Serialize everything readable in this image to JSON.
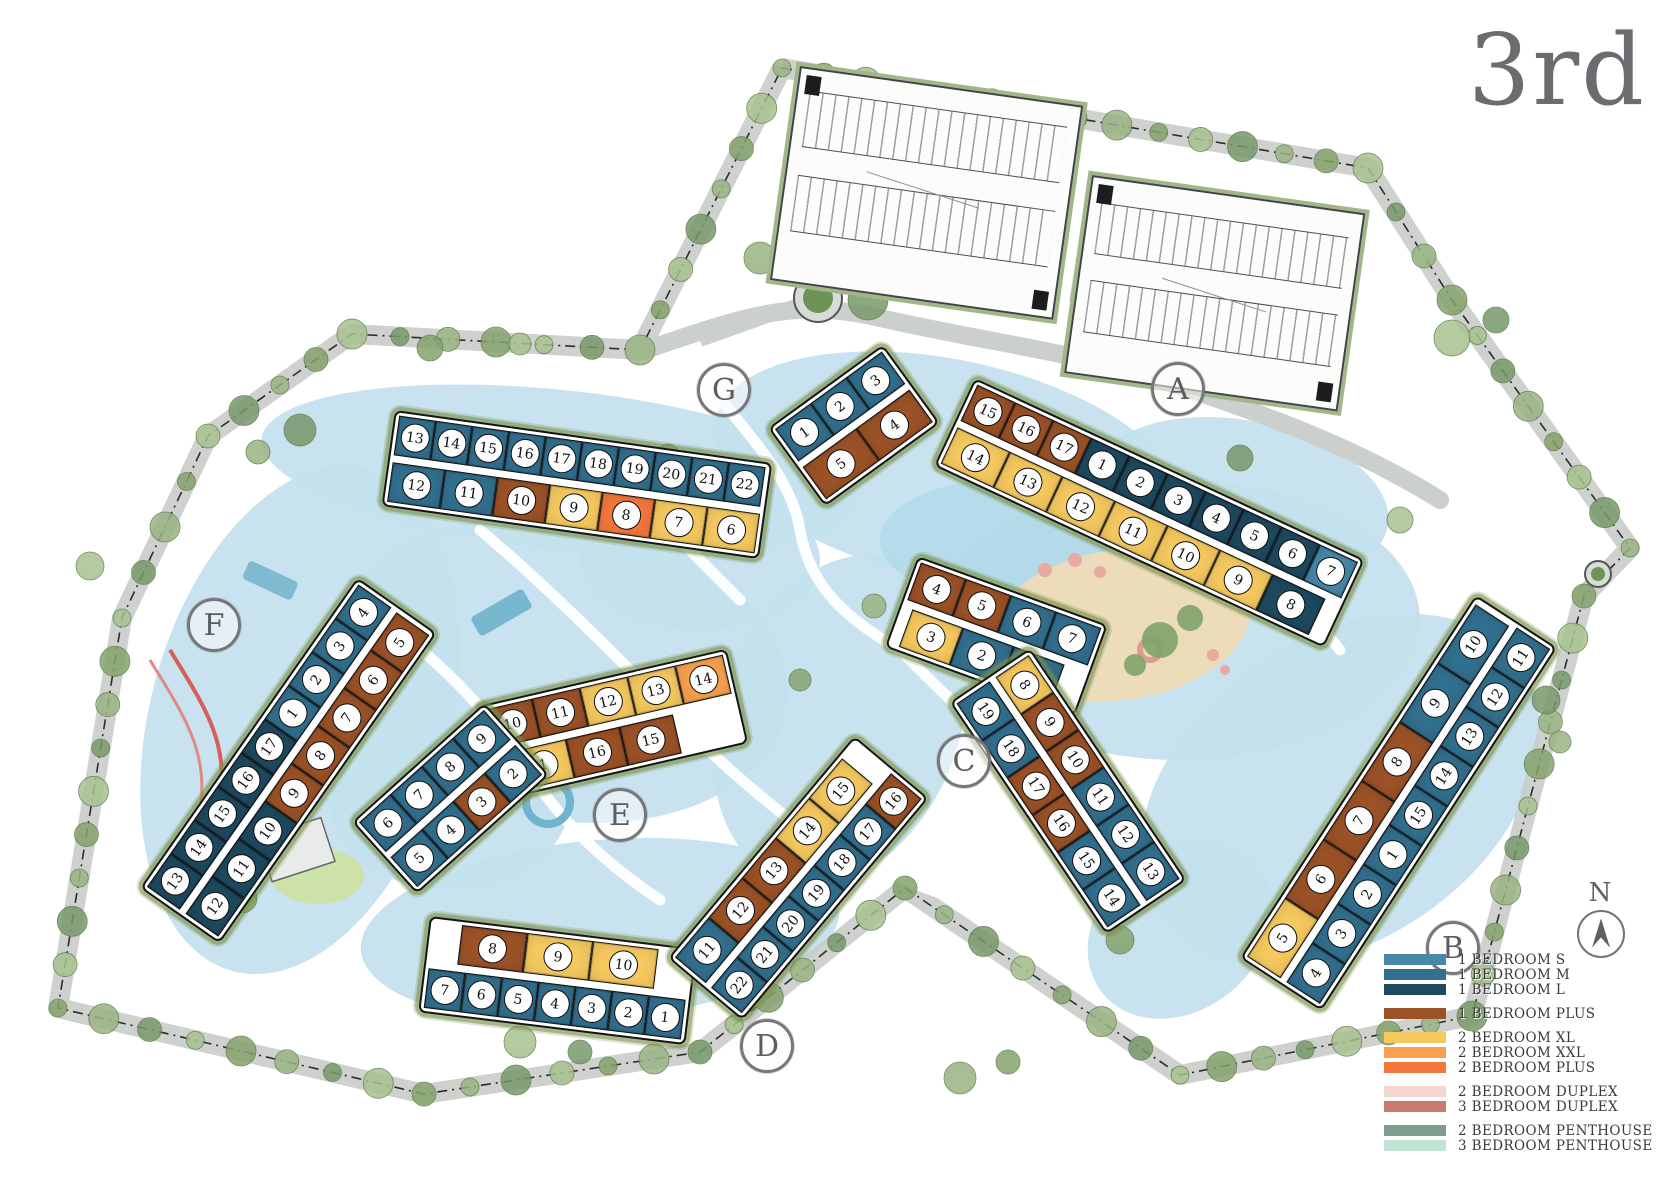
{
  "title": "3rd",
  "compass": {
    "label": "N"
  },
  "legend": {
    "groups": [
      {
        "items": [
          {
            "key": "b1s",
            "label": "1 BEDROOM S",
            "color": "#4788aa"
          },
          {
            "key": "b1m",
            "label": "1 BEDROOM M",
            "color": "#32708f"
          },
          {
            "key": "b1l",
            "label": "1 BEDROOM L",
            "color": "#1d4a61"
          }
        ]
      },
      {
        "items": [
          {
            "key": "b1plus",
            "label": "1 BEDROOM PLUS",
            "color": "#9c5227"
          }
        ]
      },
      {
        "items": [
          {
            "key": "b2xl",
            "label": "2 BEDROOM XL",
            "color": "#f6c95f"
          },
          {
            "key": "b2xxl",
            "label": "2 BEDROOM XXL",
            "color": "#f8a14e"
          },
          {
            "key": "b2plus",
            "label": "2 BEDROOM PLUS",
            "color": "#f4773d"
          }
        ]
      },
      {
        "items": [
          {
            "key": "b2duplex",
            "label": "2 BEDROOM DUPLEX",
            "color": "#f2d8cf"
          },
          {
            "key": "b3duplex",
            "label": "3 BEDROOM DUPLEX",
            "color": "#ca7b6d"
          }
        ]
      },
      {
        "items": [
          {
            "key": "b2ph",
            "label": "2 BEDROOM PENTHOUSE",
            "color": "#7d9d8d"
          },
          {
            "key": "b3ph",
            "label": "3 BEDROOM PENTHOUSE",
            "color": "#c2e4d4"
          }
        ]
      }
    ]
  },
  "buildings": [
    {
      "id": "G",
      "badge": {
        "x": 723,
        "y": 389
      },
      "segments": [
        {
          "x": 395,
          "y": 410,
          "angle": 8,
          "rows": [
            {
              "w": 37,
              "units": [
                {
                  "n": "13",
                  "t": "b1m"
                },
                {
                  "n": "14",
                  "t": "b1m"
                },
                {
                  "n": "15",
                  "t": "b1m"
                },
                {
                  "n": "16",
                  "t": "b1m"
                },
                {
                  "n": "17",
                  "t": "b1m"
                },
                {
                  "n": "18",
                  "t": "b1m"
                },
                {
                  "n": "19",
                  "t": "b1m"
                },
                {
                  "n": "20",
                  "t": "b1m"
                },
                {
                  "n": "21",
                  "t": "b1m"
                },
                {
                  "n": "22",
                  "t": "b1m"
                }
              ]
            },
            {
              "w": 53,
              "units": [
                {
                  "n": "12",
                  "t": "b1m"
                },
                {
                  "n": "11",
                  "t": "b1m"
                },
                {
                  "n": "10",
                  "t": "b1plus"
                },
                {
                  "n": "9",
                  "t": "b2xl"
                },
                {
                  "n": "8",
                  "t": "b2plus"
                },
                {
                  "n": "7",
                  "t": "b2xl"
                },
                {
                  "n": "6",
                  "t": "b2xl"
                }
              ]
            }
          ]
        },
        {
          "x": 768,
          "y": 428,
          "angle": -36,
          "rows": [
            {
              "w": 44,
              "units": [
                {
                  "n": "1",
                  "t": "b1m"
                },
                {
                  "n": "2",
                  "t": "b1m"
                },
                {
                  "n": "3",
                  "t": "b1m"
                }
              ]
            },
            {
              "w": 66,
              "units": [
                {
                  "n": "5",
                  "t": "b1plus"
                },
                {
                  "n": "4",
                  "t": "b1plus"
                }
              ]
            }
          ]
        }
      ]
    },
    {
      "id": "A",
      "badge": {
        "x": 1177,
        "y": 388
      },
      "segments": [
        {
          "x": 975,
          "y": 378,
          "angle": 25,
          "rows": [
            {
              "w": 42,
              "units": [
                {
                  "n": "15",
                  "t": "b1plus"
                },
                {
                  "n": "16",
                  "t": "b1plus"
                },
                {
                  "n": "17",
                  "t": "b1plus"
                },
                {
                  "n": "1",
                  "t": "b1l"
                },
                {
                  "n": "2",
                  "t": "b1l"
                },
                {
                  "n": "3",
                  "t": "b1l"
                },
                {
                  "n": "4",
                  "t": "b1l"
                },
                {
                  "n": "5",
                  "t": "b1l"
                },
                {
                  "n": "6",
                  "t": "b1l"
                },
                {
                  "n": "7",
                  "t": "b1s"
                }
              ]
            },
            {
              "w": 58,
              "units": [
                {
                  "n": "14",
                  "t": "b2xl"
                },
                {
                  "n": "13",
                  "t": "b2xl"
                },
                {
                  "n": "12",
                  "t": "b2xl"
                },
                {
                  "n": "11",
                  "t": "b2xl"
                },
                {
                  "n": "10",
                  "t": "b2xl"
                },
                {
                  "n": "9",
                  "t": "b2xl"
                },
                {
                  "n": "8",
                  "t": "b1l"
                }
              ]
            }
          ]
        }
      ]
    },
    {
      "id": "B",
      "badge": {
        "x": 1452,
        "y": 947
      },
      "segments": [
        {
          "x": 1240,
          "y": 958,
          "angle": -57,
          "rows": [
            {
              "w": 70,
              "units": [
                {
                  "n": "5",
                  "t": "b2xl"
                },
                {
                  "n": "6",
                  "t": "b1plus"
                },
                {
                  "n": "7",
                  "t": "b1plus"
                },
                {
                  "n": "8",
                  "t": "b1plus"
                },
                {
                  "n": "9",
                  "t": "b1m"
                },
                {
                  "n": "10",
                  "t": "b1m"
                }
              ]
            },
            {
              "w": 47,
              "units": [
                {
                  "n": "4",
                  "t": "b1m"
                },
                {
                  "n": "3",
                  "t": "b1m"
                },
                {
                  "n": "2",
                  "t": "b1m"
                },
                {
                  "n": "1",
                  "t": "b1m"
                },
                {
                  "n": "15",
                  "t": "b1m"
                },
                {
                  "n": "14",
                  "t": "b1m"
                },
                {
                  "n": "13",
                  "t": "b1m"
                },
                {
                  "n": "12",
                  "t": "b1m"
                },
                {
                  "n": "11",
                  "t": "b1m"
                }
              ]
            }
          ]
        }
      ]
    },
    {
      "id": "C",
      "badge": {
        "x": 963,
        "y": 760
      },
      "segments": [
        {
          "x": 918,
          "y": 556,
          "angle": 20,
          "rows": [
            {
              "w": 48,
              "units": [
                {
                  "n": "4",
                  "t": "b1plus"
                },
                {
                  "n": "5",
                  "t": "b1plus"
                },
                {
                  "n": "6",
                  "t": "b1m"
                },
                {
                  "n": "7",
                  "t": "b1m"
                }
              ]
            },
            {
              "w": 54,
              "ml": 8,
              "units": [
                {
                  "n": "3",
                  "t": "b2xl"
                },
                {
                  "n": "2",
                  "t": "b1m"
                },
                {
                  "n": "1",
                  "t": "b1m"
                }
              ]
            }
          ]
        },
        {
          "x": 1030,
          "y": 648,
          "angle": 56,
          "rows": [
            {
              "w": 45,
              "units": [
                {
                  "n": "8",
                  "t": "b2xl"
                },
                {
                  "n": "9",
                  "t": "b1plus"
                },
                {
                  "n": "10",
                  "t": "b1plus"
                },
                {
                  "n": "11",
                  "t": "b1m"
                },
                {
                  "n": "12",
                  "t": "b1m"
                },
                {
                  "n": "13",
                  "t": "b1m"
                }
              ]
            },
            {
              "w": 45,
              "units": [
                {
                  "n": "19",
                  "t": "b1m"
                },
                {
                  "n": "18",
                  "t": "b1m"
                },
                {
                  "n": "17",
                  "t": "b1plus"
                },
                {
                  "n": "16",
                  "t": "b1plus"
                },
                {
                  "n": "15",
                  "t": "b1m"
                },
                {
                  "n": "14",
                  "t": "b1m"
                }
              ]
            }
          ]
        }
      ]
    },
    {
      "id": "D",
      "badge": {
        "x": 766,
        "y": 1045
      },
      "segments": [
        {
          "x": 430,
          "y": 916,
          "angle": 7,
          "rows": [
            {
              "w": 66,
              "ml": 28,
              "units": [
                {
                  "n": "8",
                  "t": "b1plus"
                },
                {
                  "n": "9",
                  "t": "b2xl"
                },
                {
                  "n": "10",
                  "t": "b2xl"
                }
              ]
            },
            {
              "w": 37,
              "units": [
                {
                  "n": "7",
                  "t": "b1m"
                },
                {
                  "n": "6",
                  "t": "b1m"
                },
                {
                  "n": "5",
                  "t": "b1m"
                },
                {
                  "n": "4",
                  "t": "b1m"
                },
                {
                  "n": "3",
                  "t": "b1m"
                },
                {
                  "n": "2",
                  "t": "b1m"
                },
                {
                  "n": "1",
                  "t": "b1m"
                }
              ]
            }
          ]
        },
        {
          "x": 668,
          "y": 958,
          "angle": -50,
          "rows": [
            {
              "w": 52,
              "units": [
                {
                  "n": "11",
                  "t": "b1m"
                },
                {
                  "n": "12",
                  "t": "b1plus"
                },
                {
                  "n": "13",
                  "t": "b1plus"
                },
                {
                  "n": "14",
                  "t": "b2xl"
                },
                {
                  "n": "15",
                  "t": "b2xl"
                }
              ]
            },
            {
              "w": 40,
              "units": [
                {
                  "n": "22",
                  "t": "b1m"
                },
                {
                  "n": "21",
                  "t": "b1m"
                },
                {
                  "n": "20",
                  "t": "b1m"
                },
                {
                  "n": "19",
                  "t": "b1m"
                },
                {
                  "n": "18",
                  "t": "b1m"
                },
                {
                  "n": "17",
                  "t": "b1m"
                },
                {
                  "n": "16",
                  "t": "b1plus"
                }
              ]
            }
          ]
        }
      ]
    },
    {
      "id": "E",
      "badge": {
        "x": 619,
        "y": 814
      },
      "segments": [
        {
          "x": 478,
          "y": 706,
          "angle": -13,
          "rows": [
            {
              "w": 49,
              "units": [
                {
                  "n": "10",
                  "t": "b1plus"
                },
                {
                  "n": "11",
                  "t": "b1plus"
                },
                {
                  "n": "12",
                  "t": "b2xl"
                },
                {
                  "n": "13",
                  "t": "b2xl"
                },
                {
                  "n": "14",
                  "t": "b2xxl"
                }
              ]
            },
            {
              "w": 55,
              "ml": 18,
              "units": [
                {
                  "n": "1",
                  "t": "b2xl"
                },
                {
                  "n": "16",
                  "t": "b1plus"
                },
                {
                  "n": "15",
                  "t": "b1plus"
                }
              ]
            }
          ]
        },
        {
          "x": 352,
          "y": 822,
          "angle": -42,
          "rows": [
            {
              "w": 42,
              "units": [
                {
                  "n": "6",
                  "t": "b1m"
                },
                {
                  "n": "7",
                  "t": "b1m"
                },
                {
                  "n": "8",
                  "t": "b1m"
                },
                {
                  "n": "9",
                  "t": "b1m"
                }
              ]
            },
            {
              "w": 42,
              "units": [
                {
                  "n": "5",
                  "t": "b1m"
                },
                {
                  "n": "4",
                  "t": "b1m"
                },
                {
                  "n": "3",
                  "t": "b1plus"
                },
                {
                  "n": "2",
                  "t": "b1m"
                }
              ]
            }
          ]
        }
      ]
    },
    {
      "id": "F",
      "badge": {
        "x": 213,
        "y": 624
      },
      "segments": [
        {
          "x": 140,
          "y": 888,
          "angle": -55,
          "rows": [
            {
              "w": 41,
              "units": [
                {
                  "n": "13",
                  "t": "b1l"
                },
                {
                  "n": "14",
                  "t": "b1l"
                },
                {
                  "n": "15",
                  "t": "b1l"
                },
                {
                  "n": "16",
                  "t": "b1l"
                },
                {
                  "n": "17",
                  "t": "b1l"
                },
                {
                  "n": "1",
                  "t": "b1m"
                },
                {
                  "n": "2",
                  "t": "b1m"
                },
                {
                  "n": "3",
                  "t": "b1m"
                },
                {
                  "n": "4",
                  "t": "b1m"
                }
              ]
            },
            {
              "w": 46,
              "units": [
                {
                  "n": "12",
                  "t": "b1l"
                },
                {
                  "n": "11",
                  "t": "b1l"
                },
                {
                  "n": "10",
                  "t": "b1l"
                },
                {
                  "n": "9",
                  "t": "b1plus"
                },
                {
                  "n": "8",
                  "t": "b1plus"
                },
                {
                  "n": "7",
                  "t": "b1plus"
                },
                {
                  "n": "6",
                  "t": "b1plus"
                },
                {
                  "n": "5",
                  "t": "b1plus"
                }
              ]
            }
          ]
        }
      ]
    }
  ]
}
